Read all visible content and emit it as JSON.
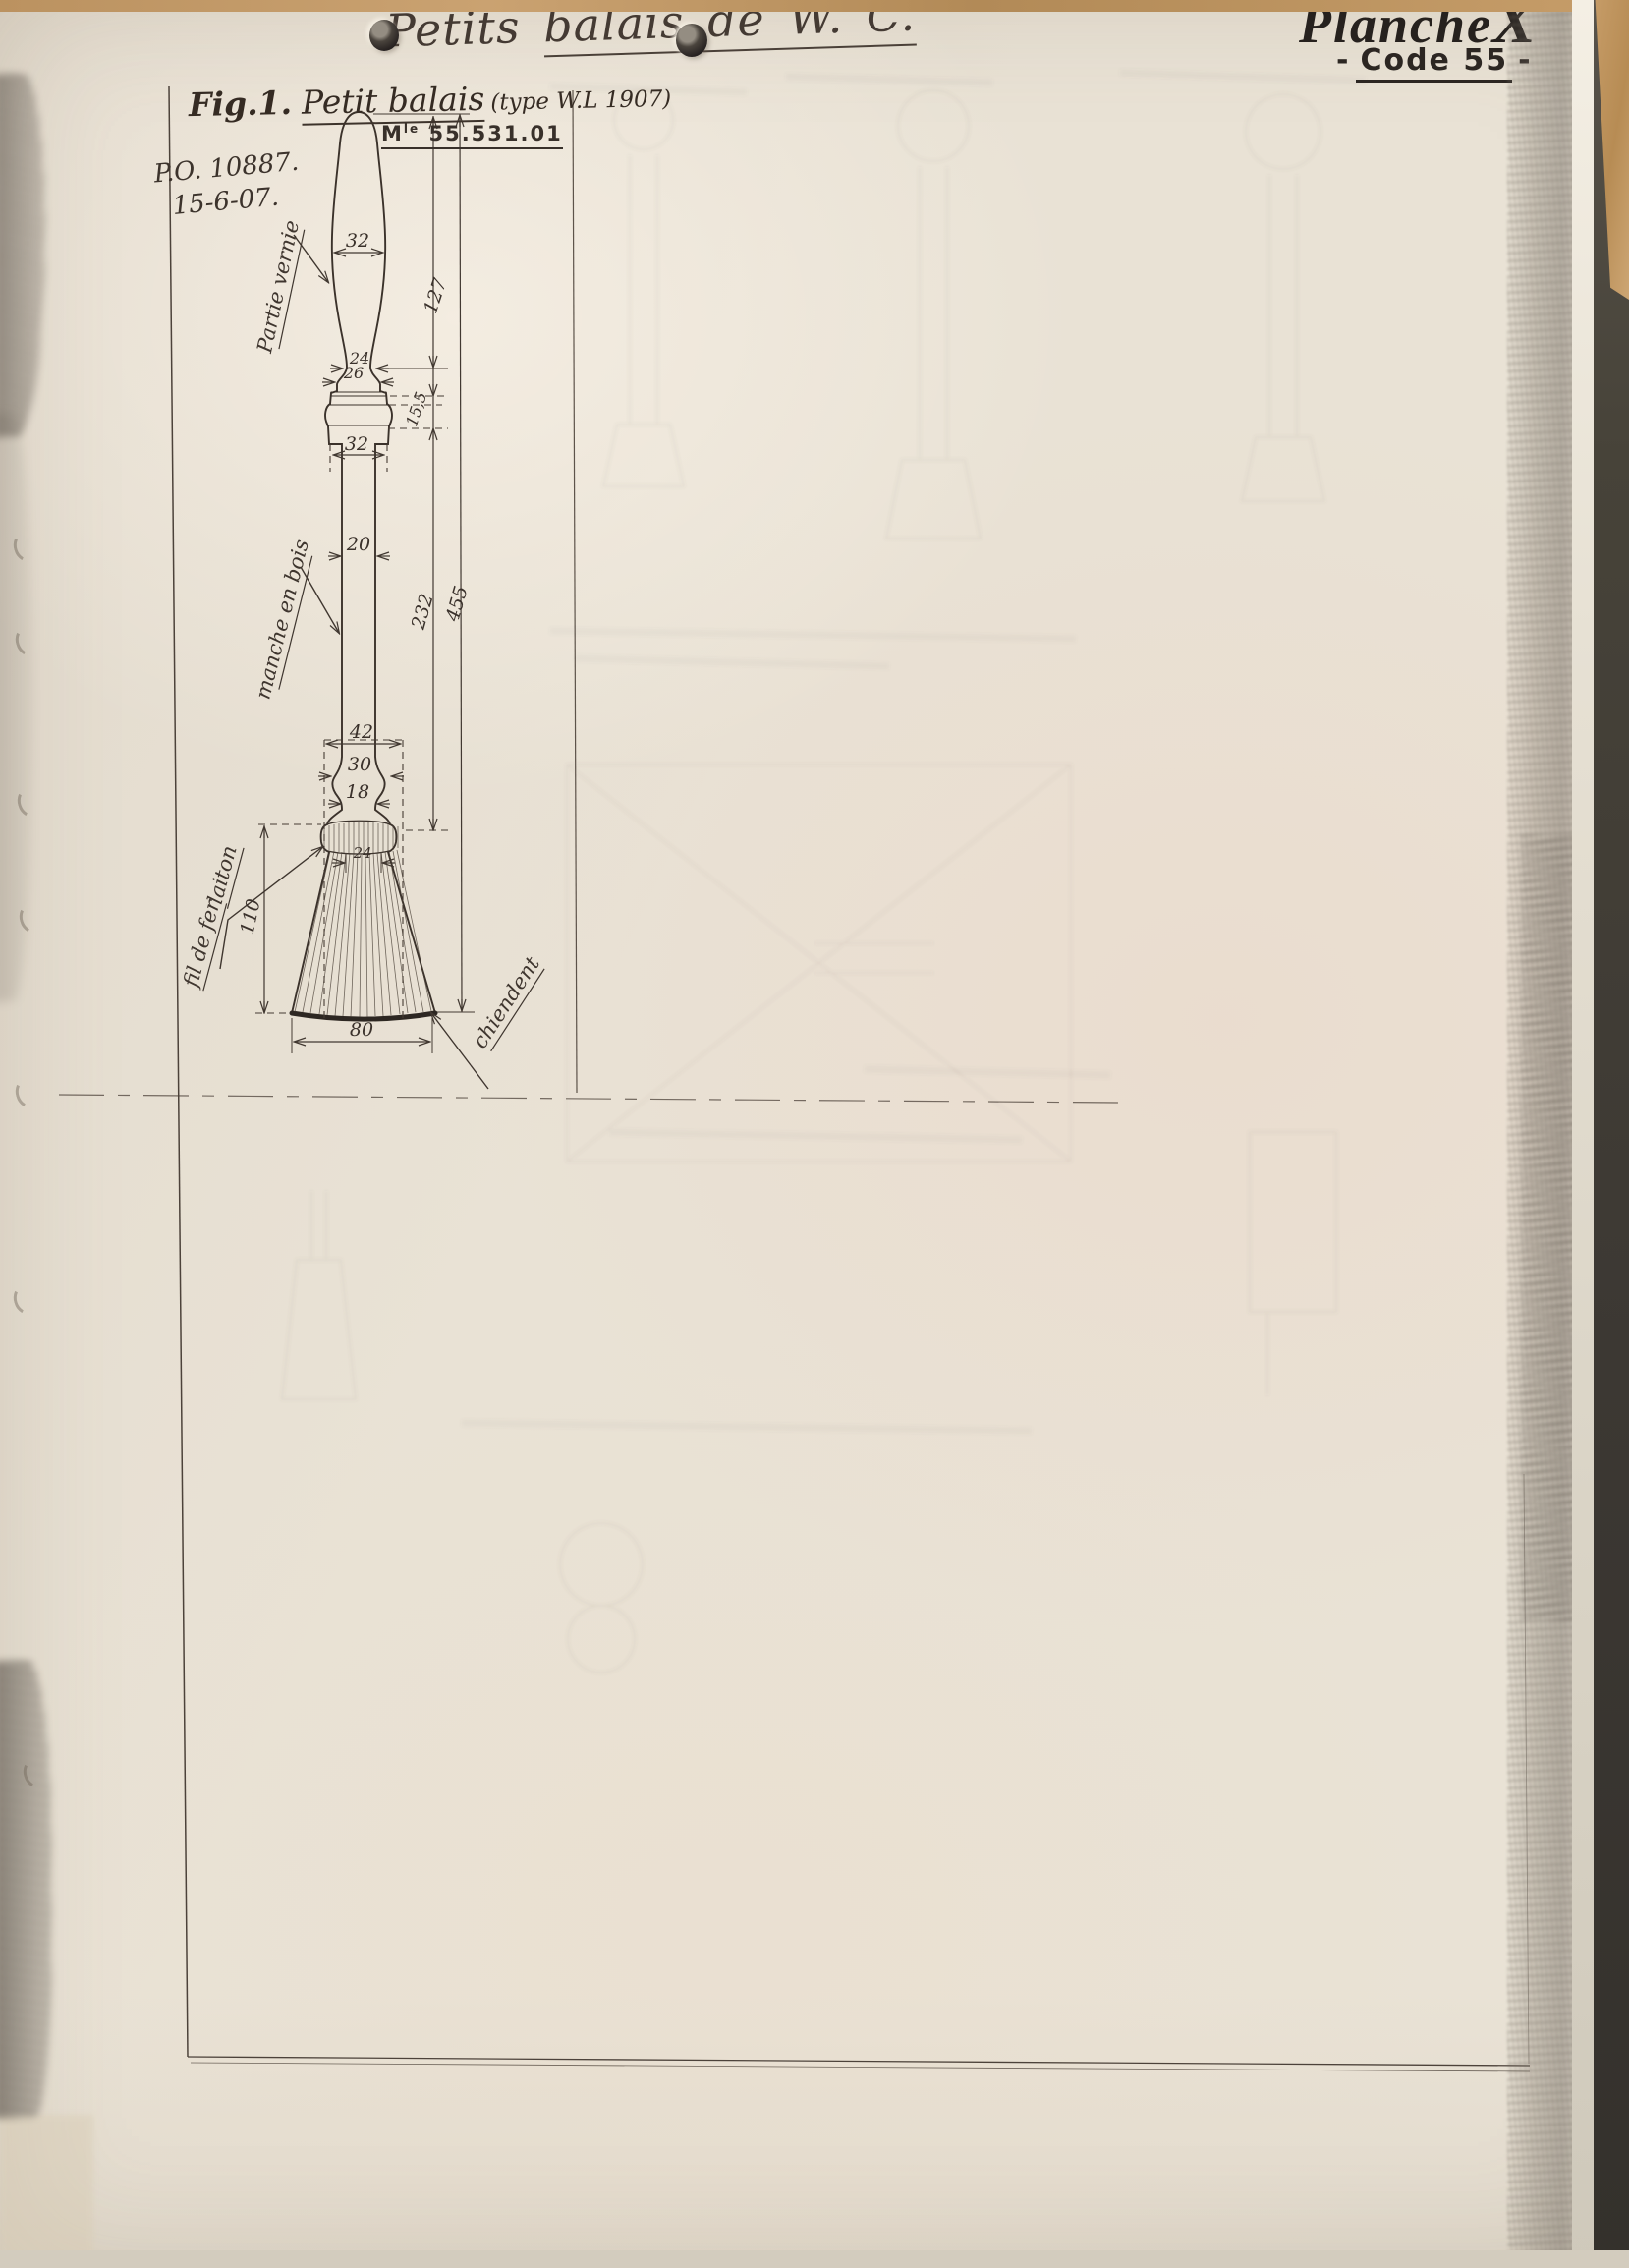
{
  "header": {
    "title_start": "Petits ",
    "title_underlined": "balais de W. C.",
    "plate_word": "Planche",
    "plate_letter": "X",
    "code_dash_left": "-",
    "code_text": "Code 55",
    "code_dash_right": "-"
  },
  "figure": {
    "caption_fig": "Fig.1.",
    "caption_name": "Petit balais",
    "caption_type": "(type W.L 1907)",
    "reference": "P.O. 10887.",
    "date": "15-6-07.",
    "model_m": "M",
    "model_sup": "le",
    "model_num": "55.531.01",
    "labels": {
      "varnished": "Partie vernie",
      "handle": "manche en bois",
      "wire_line1": "fil de fer",
      "wire_line2": "laiton",
      "bristles": "chiendent"
    },
    "dims": {
      "handle_w": "32",
      "handle_len": "127",
      "neck_top": "24",
      "neck_bottom": "26",
      "collar_h": "15,5",
      "ferrule_w": "32",
      "shaft_d": "20",
      "shaft_len": "232",
      "total_len": "455",
      "head_box": "42",
      "flare": "30",
      "tip": "18",
      "band": "24",
      "head_h": "110",
      "base_w": "80"
    }
  }
}
